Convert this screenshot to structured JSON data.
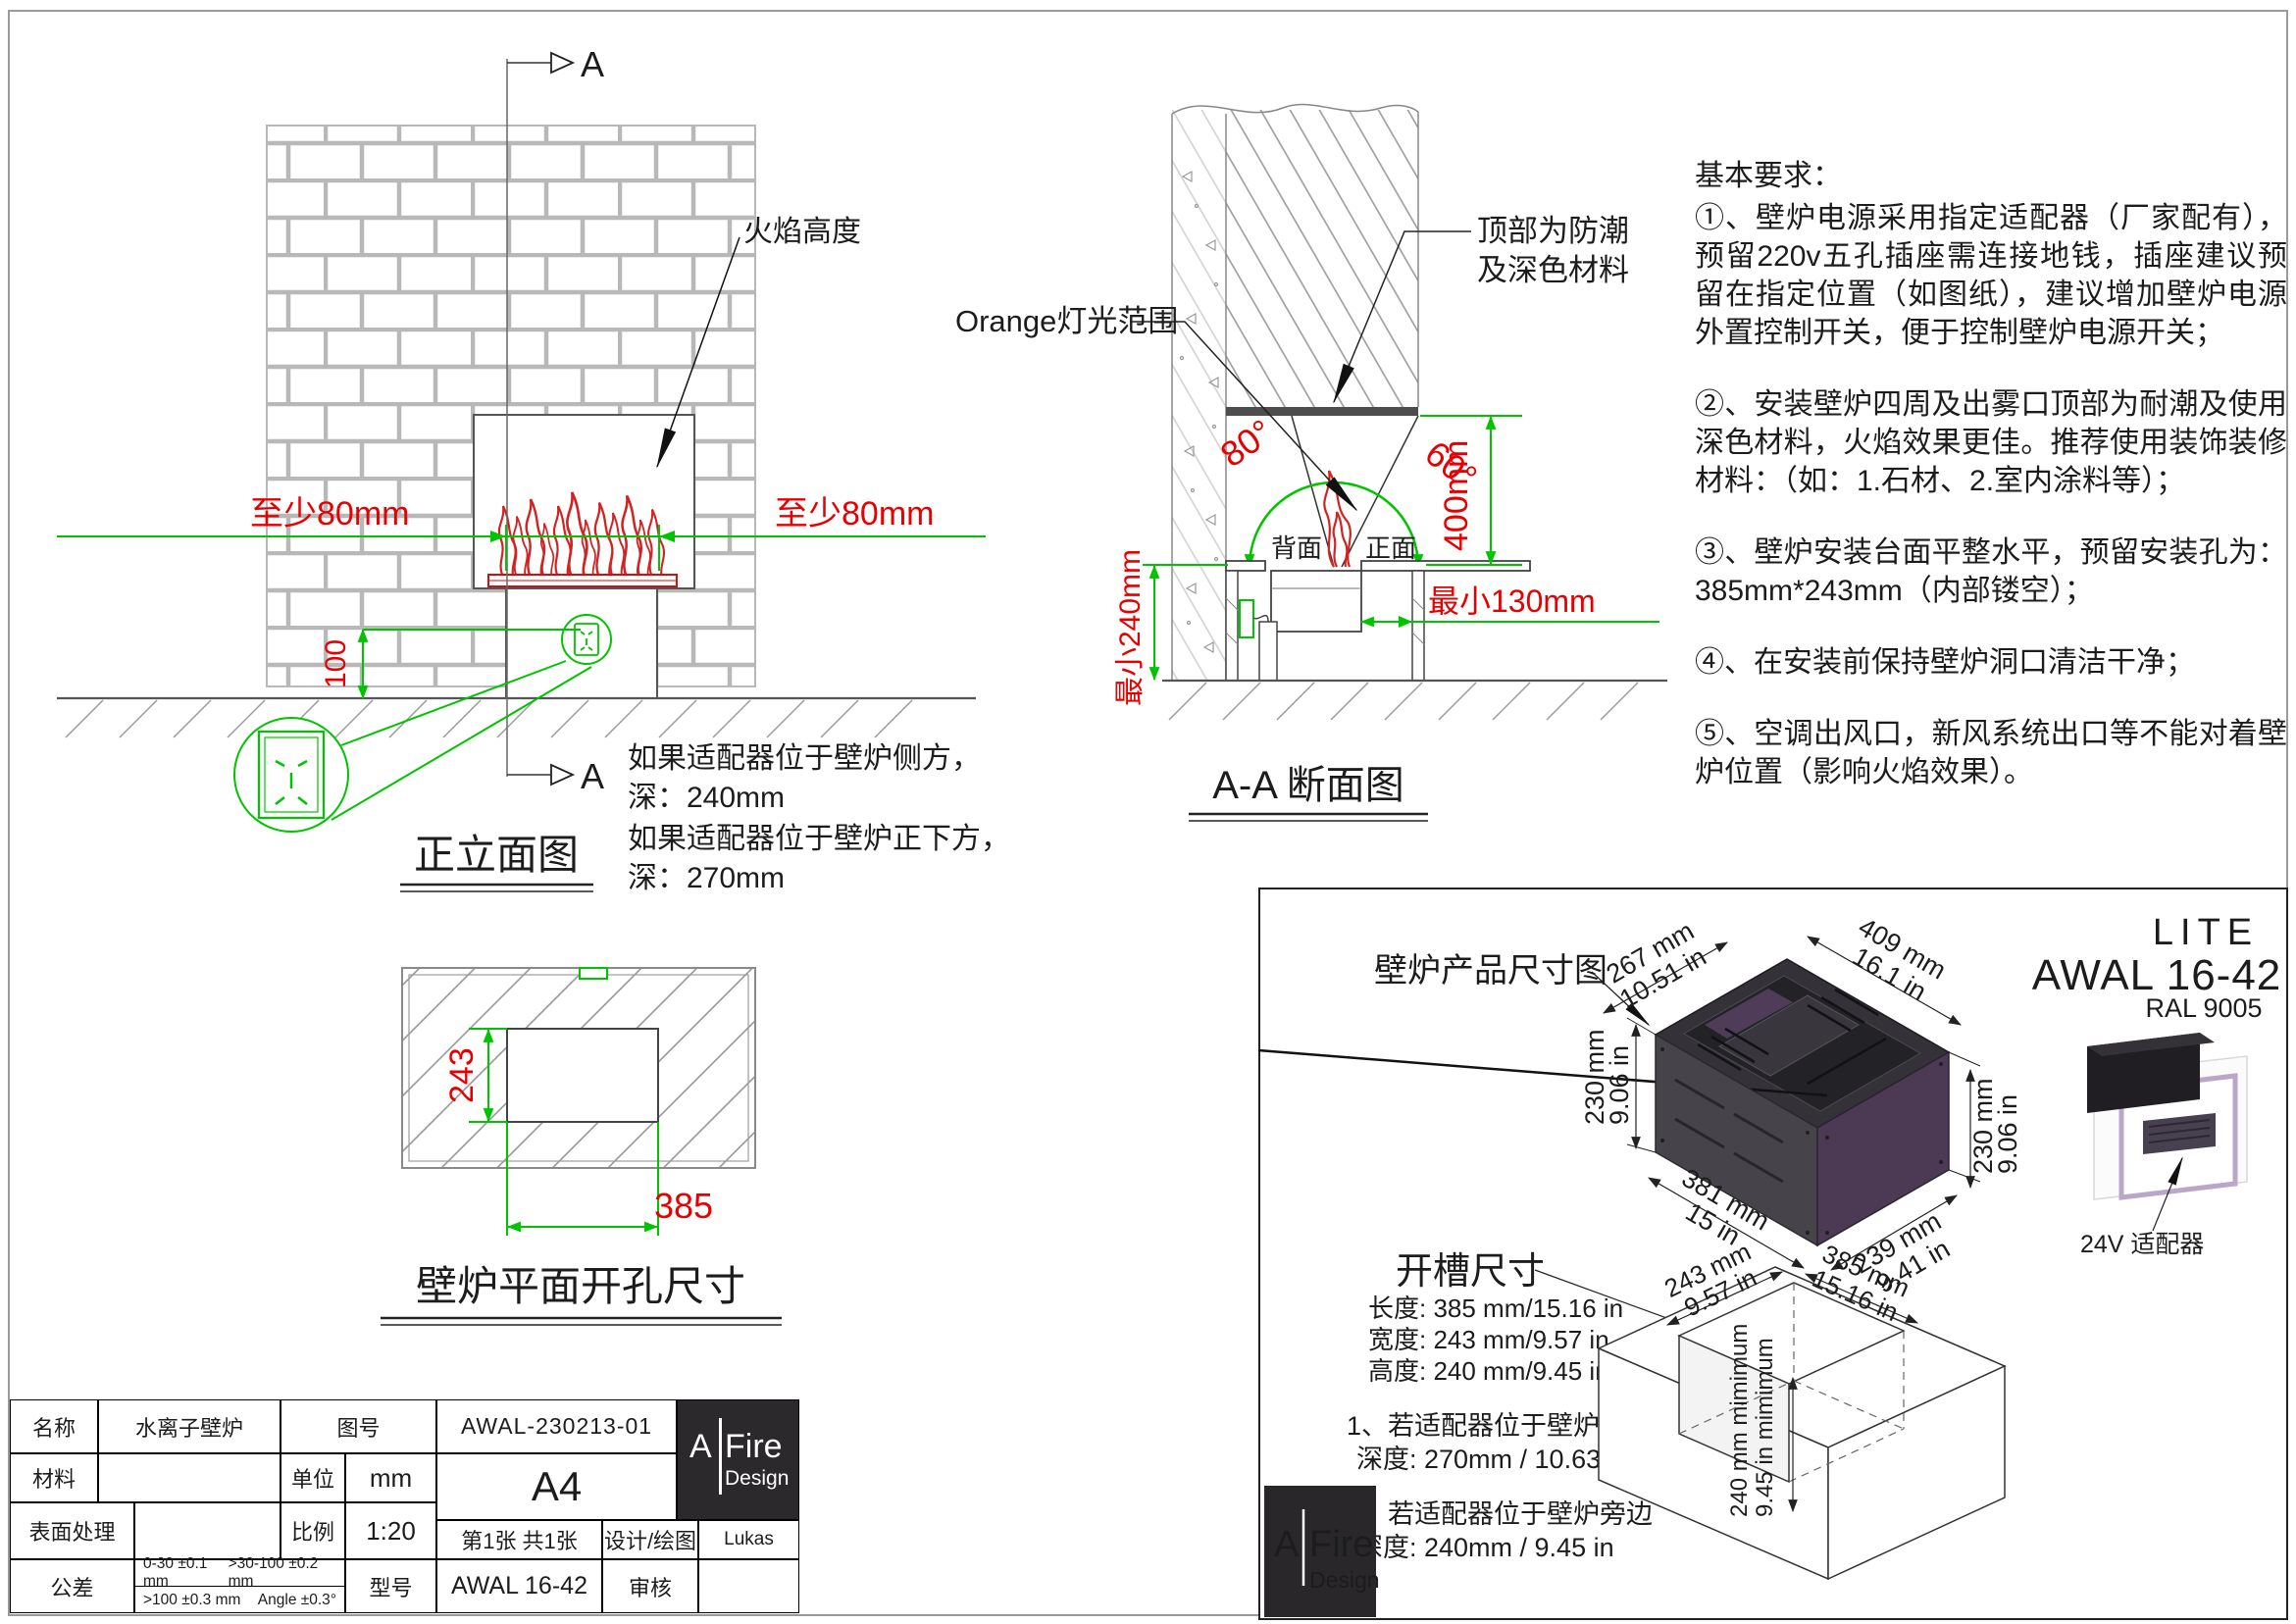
{
  "front": {
    "marker": "A",
    "flame_label": "火焰高度",
    "min_left": "至少80mm",
    "min_right": "至少80mm",
    "socket_dim": "100",
    "title": "正立面图",
    "notes": [
      "如果适配器位于壁炉侧方，",
      "深：240mm",
      "如果适配器位于壁炉正下方，",
      "深：270mm"
    ]
  },
  "section": {
    "title": "A-A 断面图",
    "top_note_1": "顶部为防潮",
    "top_note_2": "及深色材料",
    "orange_label": "Orange灯光范围",
    "angle_left": "80°",
    "angle_right": "60°",
    "dim_400": "400mm",
    "min_240": "最小240mm",
    "min_130": "最小130mm",
    "back": "背面",
    "front": "正面"
  },
  "requirements": {
    "title": "基本要求：",
    "items": [
      "①、壁炉电源采用指定适配器（厂家配有），预留220v五孔插座需连接地钱，插座建议预留在指定位置（如图纸），建议增加壁炉电源外置控制开关，便于控制壁炉电源开关；",
      "②、安装壁炉四周及出雾口顶部为耐潮及使用深色材料，火焰效果更佳。推荐使用装饰装修材料：（如：1.石材、2.室内涂料等）；",
      "③、壁炉安装台面平整水平，预留安装孔为：385mm*243mm（内部镂空）；",
      "④、在安装前保持壁炉洞口清洁干净；",
      "⑤、空调出风口，新风系统出口等不能对着壁炉位置（影响火焰效果）。"
    ]
  },
  "plan": {
    "dim_height": "243",
    "dim_width": "385",
    "title": "壁炉平面开孔尺寸"
  },
  "panel": {
    "product_label": "壁炉产品尺寸图",
    "model_line": "LITE",
    "model_code": "AWAL 16-42",
    "ral": "RAL 9005",
    "adapter_label": "24V 适配器",
    "slot_title": "开槽尺寸",
    "slot_specs": [
      "长度: 385 mm/15.16 in",
      "宽度: 243 mm/9.57 in",
      "高度: 240 mm/9.45 in"
    ],
    "note1": [
      "1、若适配器位于壁炉下方",
      "深度: 270mm / 10.63 in"
    ],
    "note2": [
      "2、若适配器位于壁炉旁边",
      "深度: 240mm / 9.45 in"
    ],
    "dims": {
      "top_left": [
        "267 mm",
        "10.51 in"
      ],
      "top_right": [
        "409 mm",
        "16.1 in"
      ],
      "left": [
        "230 mm",
        "9.06 in"
      ],
      "right": [
        "230 mm",
        "9.06 in"
      ],
      "bottom_left": [
        "381 mm",
        "15 in"
      ],
      "bottom_right": [
        "239 mm",
        "9.41 in"
      ]
    },
    "opening": {
      "left": [
        "243 mm",
        "9.57 in"
      ],
      "right": [
        "385 mm",
        "15.16 in"
      ],
      "vertical": [
        "240 mm mimimum",
        "9.45 in mimimum"
      ]
    }
  },
  "brand": {
    "a": "A",
    "fire": "Fire",
    "design": "Design"
  },
  "title_block": {
    "name_label": "名称",
    "name_value": "水离子壁炉",
    "drawing_no_label": "图号",
    "drawing_no_value": "AWAL-230213-01",
    "material_label": "材料",
    "unit_label": "单位",
    "unit_value": "mm",
    "paper": "A4",
    "surface_label": "表面处理",
    "scale_label": "比例",
    "scale_value": "1:20",
    "sheet_info": "第1张 共1张",
    "designer_label": "设计/绘图",
    "designer_value": "Lukas",
    "tolerance_label": "公差",
    "tolerances": [
      "0-30 ±0.1 mm",
      ">30-100 ±0.2 mm",
      ">100 ±0.3 mm",
      "Angle ±0.3°"
    ],
    "model_label": "型号",
    "model_value": "AWAL 16-42",
    "checker_label": "审核"
  }
}
